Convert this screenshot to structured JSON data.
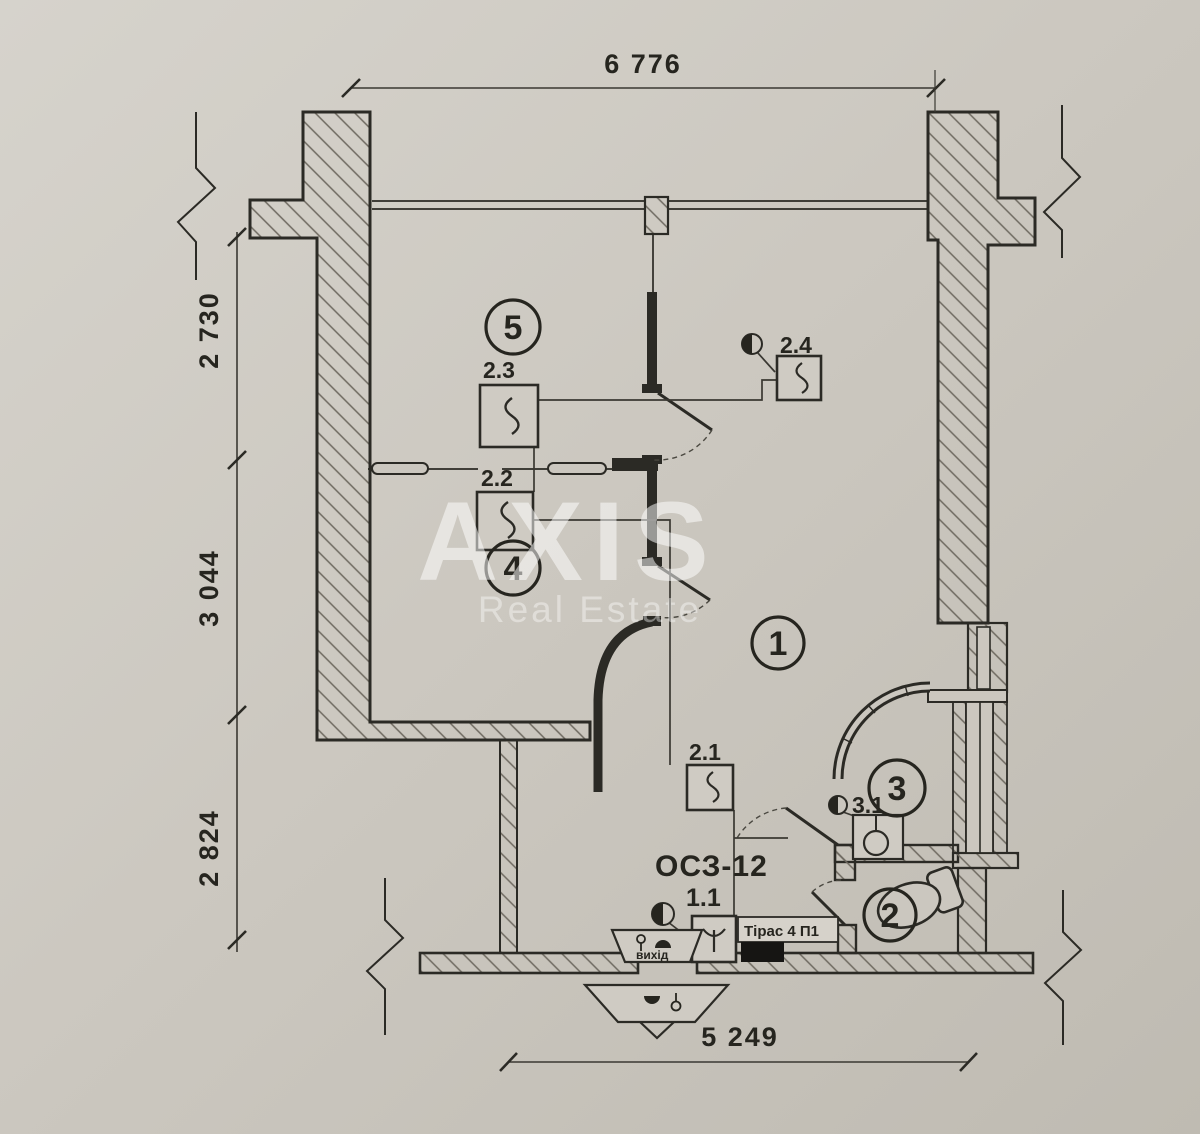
{
  "meta": {
    "type": "apartment floor plan (scanned blueprint)"
  },
  "watermark": {
    "brand": "AXIS",
    "tagline": "Real Estate"
  },
  "dimensions": {
    "top": "6 776",
    "bottom": "5 249",
    "left_top": "2 730",
    "left_middle": "3 044",
    "left_bottom": "2 824"
  },
  "rooms": {
    "r1": "1",
    "r2": "2",
    "r3": "3",
    "r4": "4",
    "r5": "5"
  },
  "labels": {
    "d21": "2.1",
    "d22": "2.2",
    "d23": "2.3",
    "d24": "2.4",
    "d31": "3.1",
    "hall": "1.1",
    "annunciator_model": "ОСЗ-12",
    "fire_panel": "Тірас 4 П1",
    "exit": "вихід"
  },
  "colors": {
    "paper": "#cbc7bf",
    "ink": "#2b2a25",
    "hatch": "#6e6960",
    "watermark": "#ffffff"
  }
}
